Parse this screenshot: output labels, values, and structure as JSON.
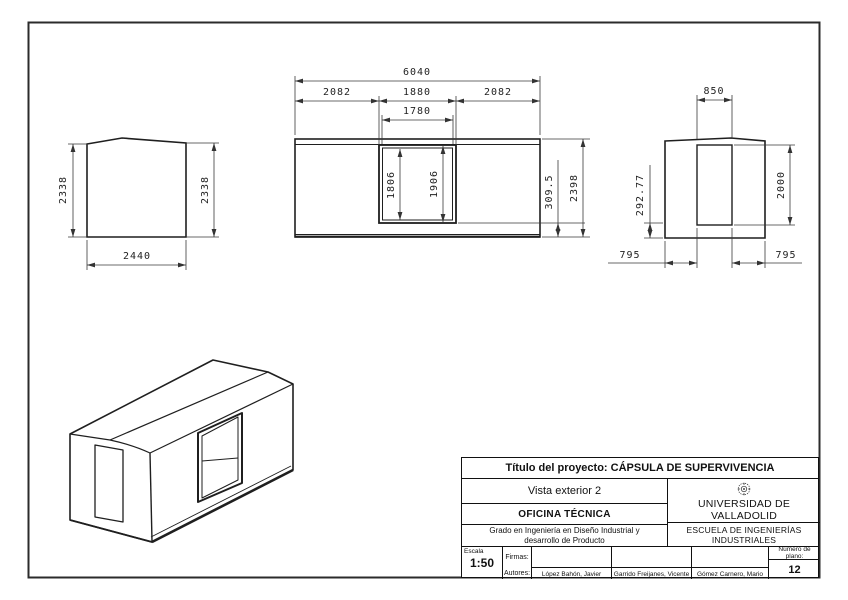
{
  "views": {
    "side_left": {
      "height_left": "2338",
      "height_right": "2338",
      "width": "2440"
    },
    "front": {
      "total_width": "6040",
      "seg_left": "2082",
      "seg_center": "1880",
      "seg_right": "2082",
      "door_top_width": "1780",
      "door_inner_height": "1806",
      "door_outer_height": "1906",
      "base_offset": "309.5",
      "total_height": "2398"
    },
    "side_right": {
      "door_width": "850",
      "base_offset": "292.77",
      "door_height": "2000",
      "offset_left": "795",
      "offset_right": "795"
    }
  },
  "title_block": {
    "project_title": "Título del proyecto: CÁPSULA DE SUPERVIVENCIA",
    "view_name": "Vista exterior 2",
    "office": "OFICINA TÉCNICA",
    "degree_line1": "Grado en Ingeniería en Diseño Industrial y",
    "degree_line2": "desarrollo de Producto",
    "university": "UNIVERSIDAD DE VALLADOLID",
    "school": "ESCUELA DE INGENIERÍAS INDUSTRIALES",
    "scale_label": "Escala",
    "scale_value": "1:50",
    "signatures_label": "Firmas:",
    "authors_label": "Autores:",
    "authors": [
      "López Bahón, Javier",
      "Garrido Freijanes, Vicente",
      "Gómez Carnero, Mario"
    ],
    "plan_number_label": "Número de plano:",
    "plan_number": "12"
  }
}
